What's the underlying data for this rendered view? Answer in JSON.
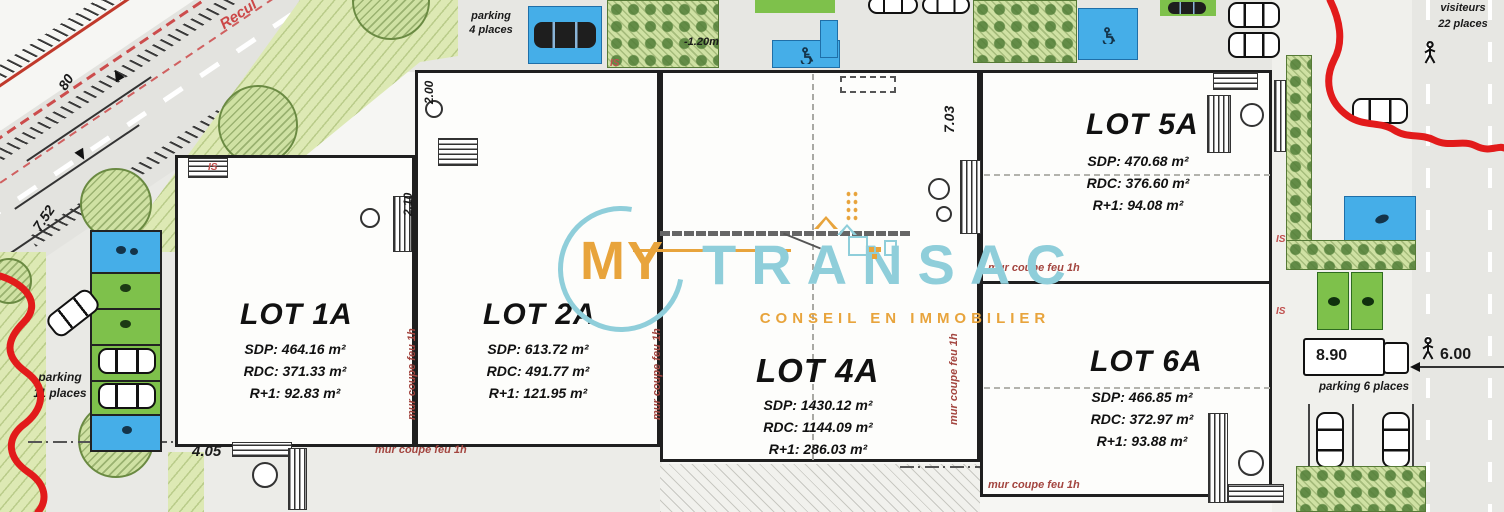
{
  "logo": {
    "word1": "MY",
    "word2": "TRANSAC",
    "tagline": "CONSEIL EN IMMOBILIER",
    "accent_orange": "#E8A43C",
    "accent_teal": "#8FCEDA"
  },
  "lots": [
    {
      "name": "LOT 1A",
      "sdp": "SDP: 464.16 m²",
      "rdc": "RDC: 371.33 m²",
      "r1": "R+1: 92.83 m²"
    },
    {
      "name": "LOT 2A",
      "sdp": "SDP: 613.72 m²",
      "rdc": "RDC: 491.77 m²",
      "r1": "R+1: 121.95 m²"
    },
    {
      "name": "LOT 4A",
      "sdp": "SDP: 1430.12 m²",
      "rdc": "RDC: 1144.09 m²",
      "r1": "R+1: 286.03 m²"
    },
    {
      "name": "LOT 5A",
      "sdp": "SDP: 470.68 m²",
      "rdc": "RDC: 376.60 m²",
      "r1": "R+1: 94.08 m²"
    },
    {
      "name": "LOT 6A",
      "sdp": "SDP: 466.85 m²",
      "rdc": "RDC: 372.97 m²",
      "r1": "R+1: 93.88 m²"
    }
  ],
  "labels": {
    "fire_wall": "mur coupe feu 1h",
    "is": "IS",
    "recul": "Recul",
    "parking_4_line1": "parking",
    "parking_4_line2": "4 places",
    "parking_11_line1": "parking",
    "parking_11_line2": "11 places",
    "parking_6": "parking 6 places",
    "visitors_line1": "visiteurs",
    "visitors_line2": "22 places"
  },
  "dimensions": {
    "road_a": "80",
    "road_b": "5.70",
    "road_c": "7.52",
    "road_d": "00",
    "b2_top": "2.00",
    "b1_right": "2.10",
    "b4_right": "7.03",
    "entry_drop": "-1.20m",
    "bottom_left": "4.05",
    "truck_length": "8.90",
    "road_width": "6.00"
  },
  "colors": {
    "wall": "#1F1F1F",
    "fire_text": "#A3453F",
    "boundary_red": "#E21B1B",
    "parking_blue": "#45AEE8",
    "stall_green": "#7EC14B",
    "landscape_green": "#DDE9B4"
  }
}
